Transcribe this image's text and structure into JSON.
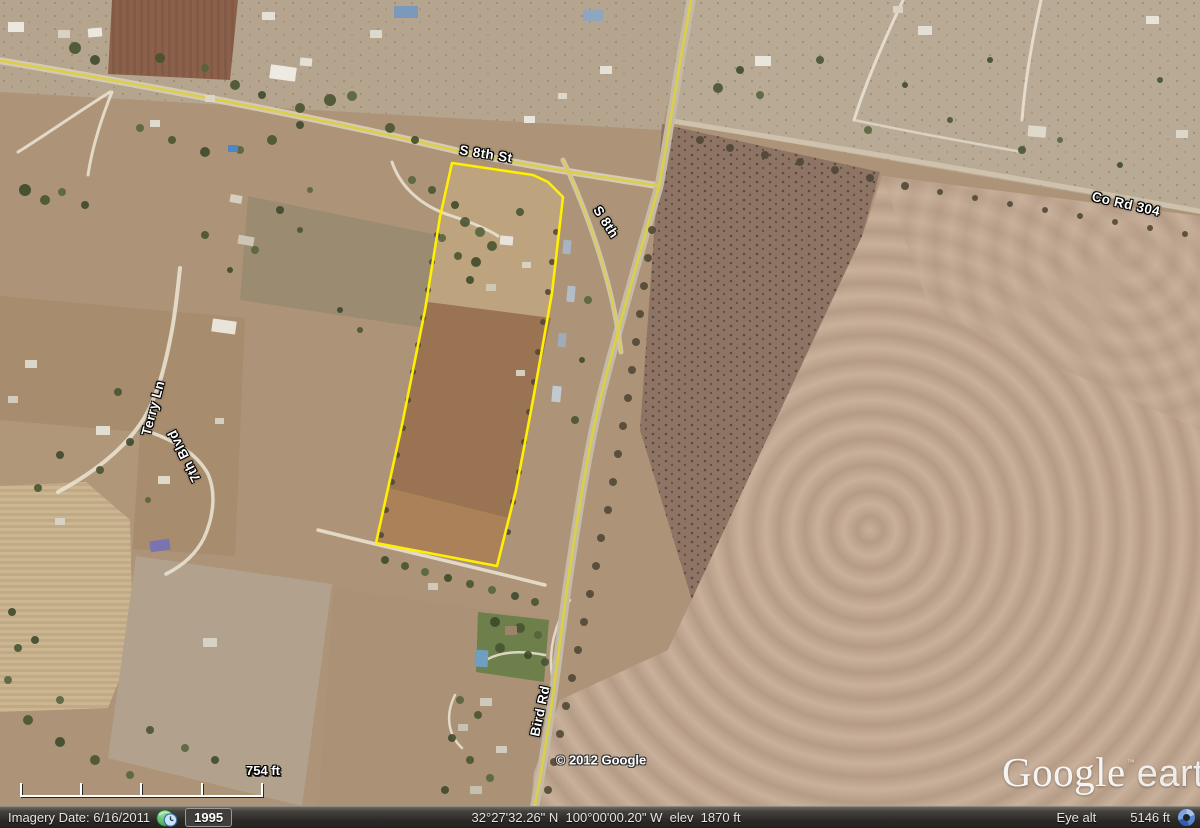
{
  "map": {
    "road_labels": [
      {
        "text": "S 8th St"
      },
      {
        "text": "S 8th"
      },
      {
        "text": "Co Rd 304"
      },
      {
        "text": "Terry Ln"
      },
      {
        "text": "7th Blvd"
      },
      {
        "text": "Bird Rd"
      }
    ]
  },
  "watermark": {
    "copyright": "© 2012 Google",
    "logo_primary": "Google",
    "logo_tm": "™",
    "logo_secondary": "earth"
  },
  "scale": {
    "label": "754 ft"
  },
  "status_bar": {
    "imagery_date": "Imagery Date: 6/16/2011",
    "history_year": "1995",
    "coordinates": "32°27'32.26\" N  100°00'00.20\" W  elev  1870 ft",
    "eye_alt_label": "Eye alt",
    "eye_alt_value": "5146 ft"
  },
  "colors": {
    "parcel_outline": "#ffef00",
    "road_overlay": "#ddce4a",
    "label_text": "#ffffff"
  },
  "icons": {
    "history_clock": "history-clock-icon",
    "streaming": "streaming-indicator-icon"
  }
}
